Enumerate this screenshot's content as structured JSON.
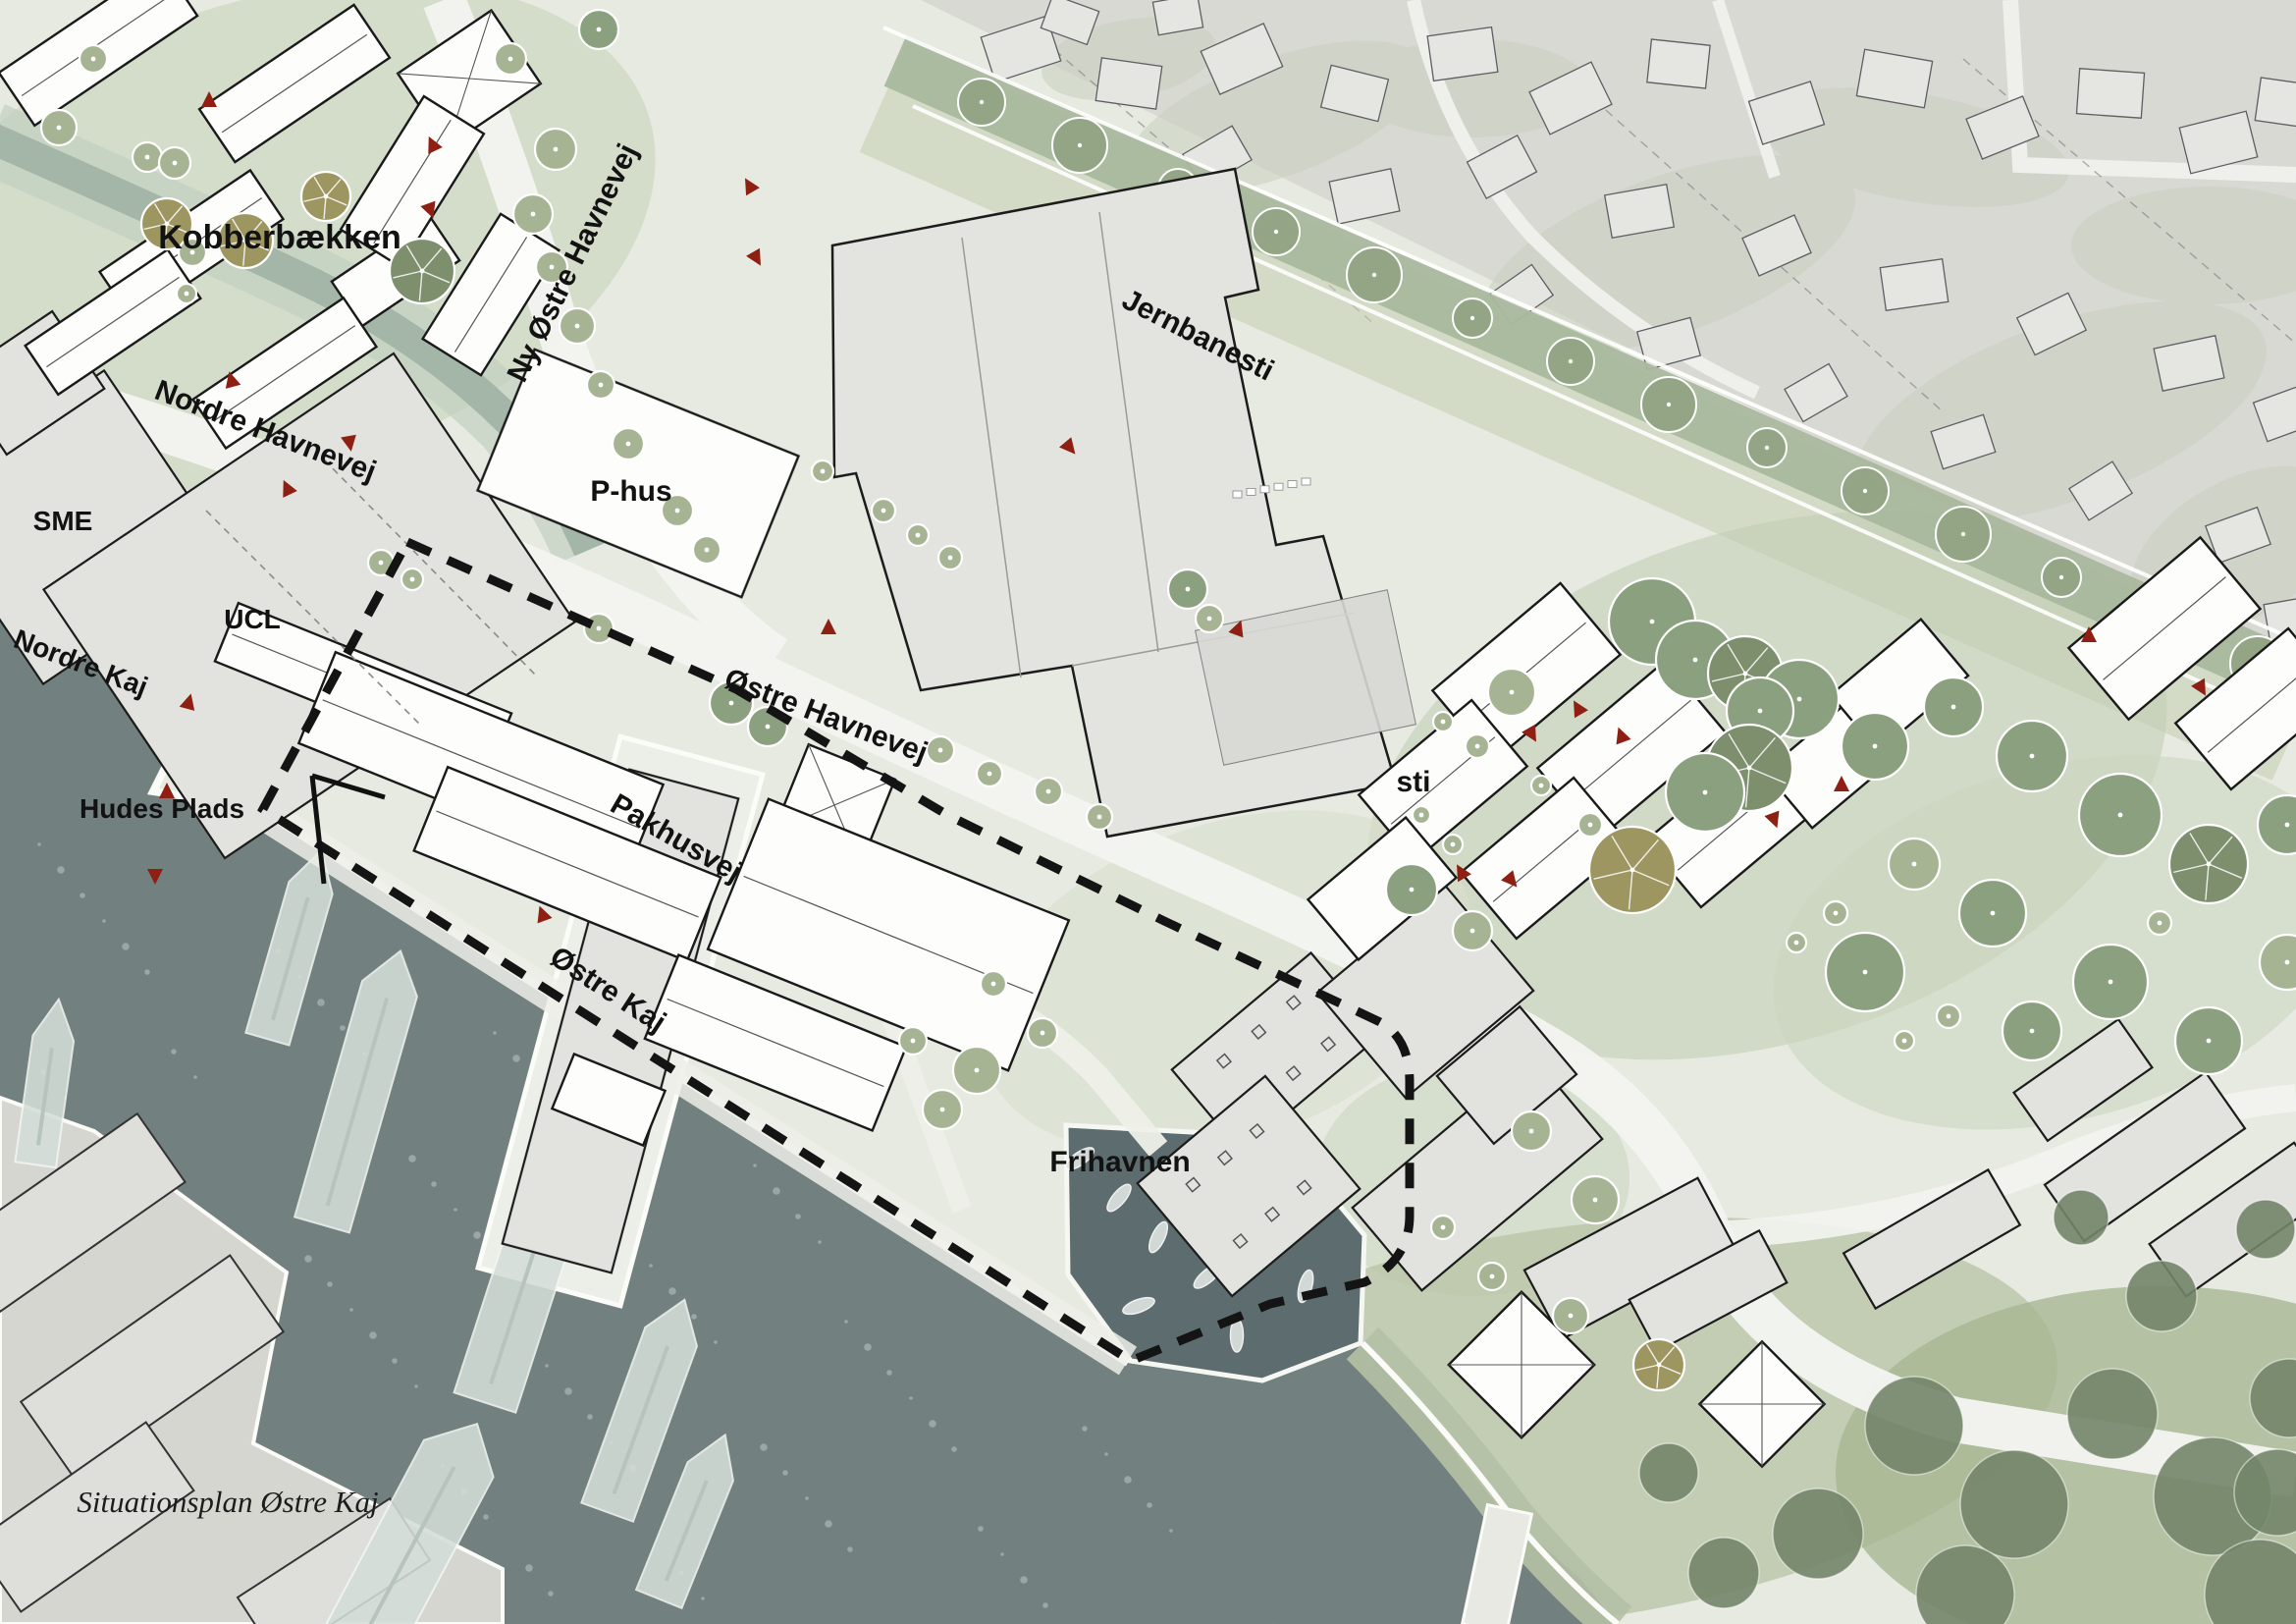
{
  "title": "Situationsplan Østre Kaj",
  "map": {
    "labels": {
      "kobberbaekken": "Kobberbækken",
      "ny_oestre_havnevej": "Ny Østre Havnevej",
      "nordre_havnevej": "Nordre Havnevej",
      "sme": "SME",
      "ucl": "UCL",
      "nordre_kaj": "Nordre Kaj",
      "hudes_plads": "Hudes Plads",
      "p_hus": "P-hus",
      "pakhusvej": "Pakhusvej",
      "oestre_havnevej": "Østre Havnevej",
      "jernbanesti": "Jernbanesti",
      "sti": "sti",
      "oestre_kaj": "Østre Kaj",
      "frihavnen": "Frihavnen"
    },
    "caption": "Situationsplan Østre Kaj",
    "colors": {
      "water": "#72807f",
      "water_dark": "#5d6c6e",
      "plan_ground": "#e7eae1",
      "plan_green": "#cfdac6",
      "railway_green": "#a9b89d",
      "tree_green": "#a7b494",
      "tree_dark": "#7d8f6d",
      "tree_olive": "#a7a06e",
      "building_white": "#fdfdfc",
      "building_gray": "#e2e2df",
      "aerial_gray": "#d9d9d4",
      "marker_red": "#8e1f12",
      "boundary_black": "#141414"
    }
  }
}
